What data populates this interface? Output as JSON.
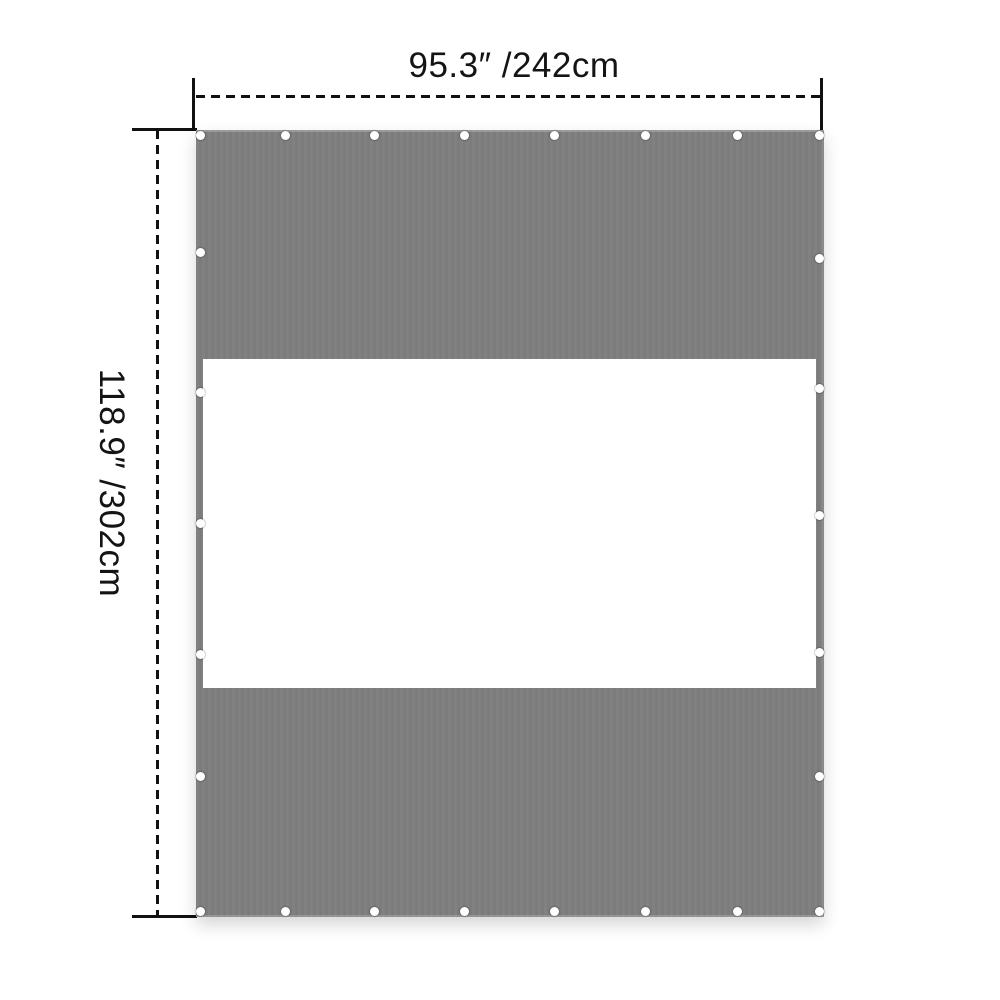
{
  "diagram": {
    "width_label": "95.3″ /242cm",
    "height_label": "118.9″ /302cm",
    "colors": {
      "panel": "#7e7e7e",
      "window": "#ffffff",
      "dimension_line": "#111111",
      "grommet": "#ffffff",
      "background": "#ffffff"
    },
    "grommets": {
      "top": {
        "y": 135,
        "xs": [
          200,
          285,
          374,
          464,
          554,
          645,
          737,
          819
        ]
      },
      "bottom": {
        "y": 911,
        "xs": [
          200,
          285,
          374,
          464,
          554,
          645,
          737,
          819
        ]
      },
      "left": {
        "x": 200,
        "ys": [
          252,
          392,
          523,
          654,
          776
        ]
      },
      "right": {
        "x": 819,
        "ys": [
          258,
          388,
          515,
          652,
          776
        ]
      }
    }
  }
}
